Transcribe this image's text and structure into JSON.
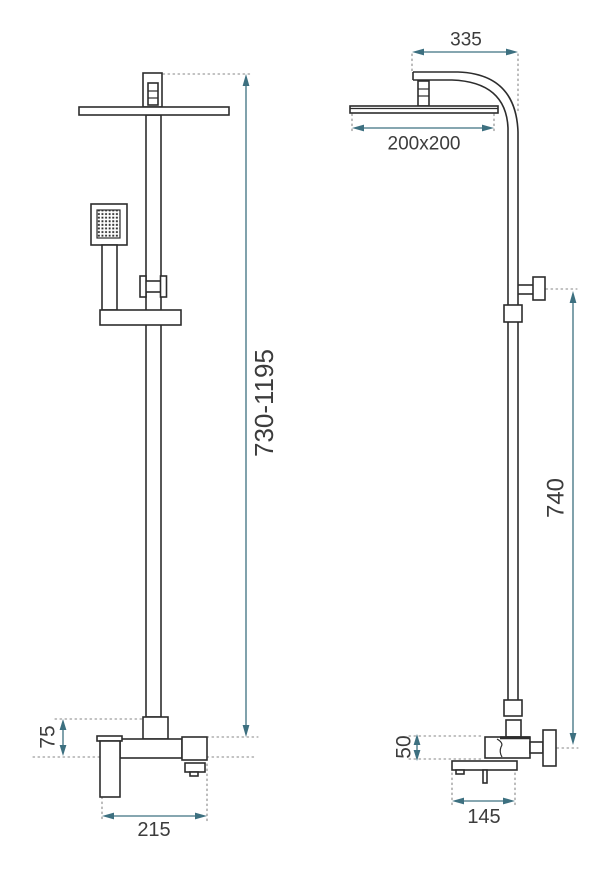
{
  "drawing": {
    "kind": "technical dimension drawing",
    "subject": "shower column set (rain head, hand shower, mixer) - front and side projections"
  },
  "dimensions": {
    "front": {
      "height_range": "730-1195",
      "mixer_offset": "75",
      "mixer_width": "215"
    },
    "side": {
      "arm_reach": "335",
      "head_size": "200x200",
      "riser_height": "740",
      "mixer_offset": "50",
      "mixer_depth": "145"
    }
  },
  "colors": {
    "background": "#ffffff",
    "outline": "#2d2d2d",
    "dimension_accent": "#3d7080",
    "extension_line": "#868686",
    "label_text": "#3c3c3c"
  }
}
